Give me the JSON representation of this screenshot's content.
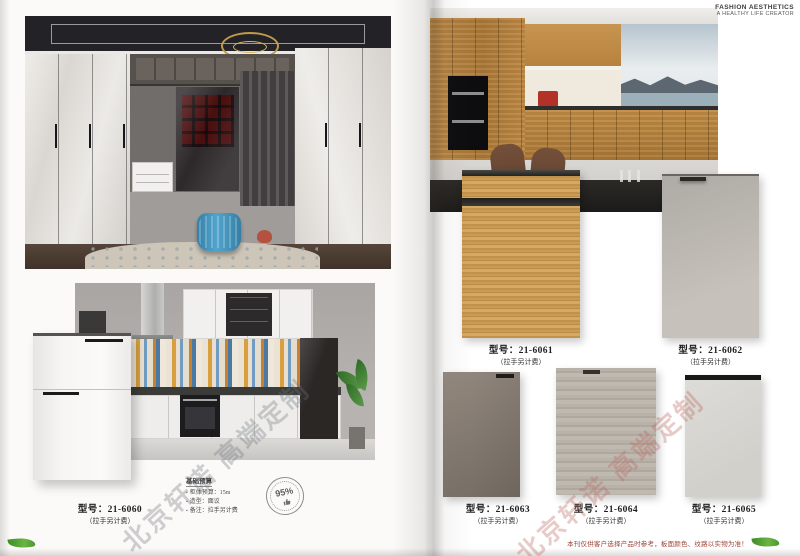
{
  "header": {
    "line1": "FASHION AESTHETICS",
    "line2": "A HEALTHY LIFE CREATOR"
  },
  "watermark": {
    "text": "北京轩诺 高端定制"
  },
  "left_page": {
    "model": {
      "prefix": "型号：",
      "code": "21-6060",
      "note": "（拉手另计费）"
    },
    "budget": {
      "title": "基础预算",
      "items": [
        {
          "text": "柜体预算：15m"
        },
        {
          "text": "造型：面议"
        },
        {
          "text": "备注：拉手另计费"
        }
      ]
    },
    "stamp": {
      "value": "95%"
    }
  },
  "right_page": {
    "swatches": [
      {
        "prefix": "型号：",
        "code": "21-6061",
        "note": "（拉手另计费）"
      },
      {
        "prefix": "型号：",
        "code": "21-6062",
        "note": "（拉手另计费）"
      },
      {
        "prefix": "型号：",
        "code": "21-6063",
        "note": "（拉手另计费）"
      },
      {
        "prefix": "型号：",
        "code": "21-6064",
        "note": "（拉手另计费）"
      },
      {
        "prefix": "型号：",
        "code": "21-6065",
        "note": "（拉手另计费）"
      }
    ]
  },
  "footer": {
    "disclaimer": "本刊仅供客户选择产品时参考，板面颜色、纹路以实物为准！"
  },
  "colors": {
    "wood_swatch": "#c0914e",
    "gray_swatch": "#b7b2ac",
    "dark_gray_swatch": "#7c7369",
    "light_wood_swatch": "#b5afa8",
    "pale_swatch": "#dbd9d5",
    "ottoman_blue": "#4495c2",
    "watermark_gray": "#6e707a",
    "watermark_red": "#ba685e",
    "disclaimer_red": "#9a4436",
    "leaf_green": "#4c9630"
  }
}
